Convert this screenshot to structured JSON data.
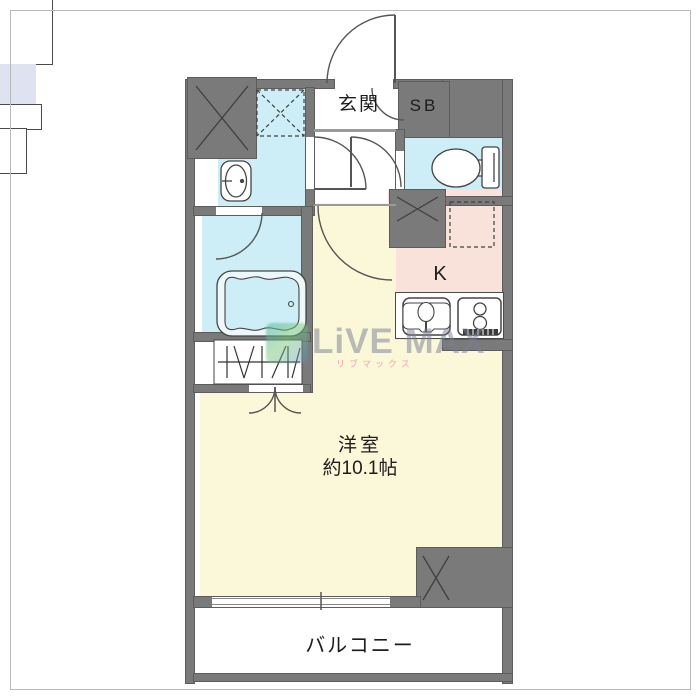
{
  "plan": {
    "labels": {
      "entrance": "玄関",
      "shoe_box": "SB",
      "kitchen": "K",
      "main_room": "洋室",
      "main_room_size": "約10.1帖",
      "balcony": "バルコニー"
    },
    "fixtures": [
      "bathtub",
      "wash-basin",
      "toilet",
      "kitchen-sink",
      "gas-stove",
      "washing-machine-space",
      "refrigerator-space",
      "closet-hanger-rod",
      "pipe-shaft",
      "pipe-shaft",
      "pipe-shaft",
      "entrance-door-swing",
      "balcony-sliding-window"
    ],
    "colors": {
      "wall": "#7a7a7a",
      "wet_area_floor": "#cdeef6",
      "kitchen_floor": "#f8e2da",
      "room_floor": "#fbf8d9",
      "shoe_box_fill": "#dfe3f1",
      "background": "#ffffff"
    },
    "watermark": {
      "brand": "LiVE MAX",
      "brand_sub": "リブマックス"
    }
  }
}
